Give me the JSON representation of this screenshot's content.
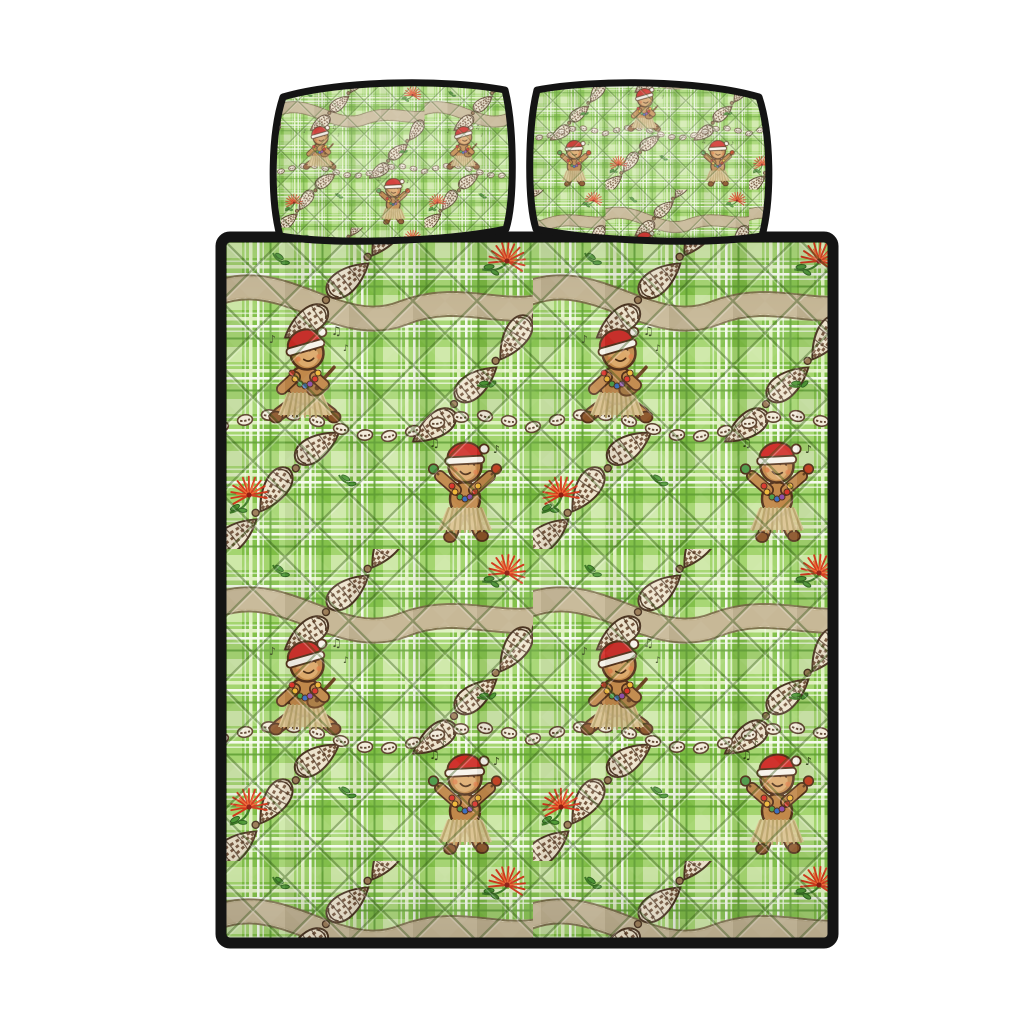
{
  "scene": {
    "label": "Quilt bedding set product photo: green plaid Hawaiian Christmas gingerbread pattern quilt with two matching pillow shams, black binding, white background",
    "items": [
      {
        "name": "pillow-sham-left",
        "type": "pillow"
      },
      {
        "name": "pillow-sham-right",
        "type": "pillow"
      },
      {
        "name": "quilt",
        "type": "quilt"
      }
    ]
  },
  "pattern": {
    "theme": "hawaiian-christmas-gingerbread",
    "fabric": "green-plaid-with-diamond-quilting",
    "motifs": [
      "gingerbread-hula-sitting-ukulele",
      "gingerbread-hula-dancing-maracas",
      "santa-hat",
      "candy-lights-lei",
      "grass-skirt",
      "cone-shell-garland",
      "puka-shell-strand",
      "white-flower-lei",
      "red-lehua-blossom",
      "green-leaf-sprig",
      "music-notes"
    ]
  },
  "colors": {
    "bg": "#ffffff",
    "binding": "#141414",
    "plaid-base": "#7ebe44",
    "plaid-light": "#a9d874",
    "plaid-pale": "#dff0c0",
    "plaid-white": "#f4faeb",
    "plaid-dark": "#5e9e33",
    "stitch": "#2f5516",
    "ginger": "#c1884a",
    "ginger-dark": "#53311a",
    "ginger-light": "#ddab6c",
    "cheek": "#df7a44",
    "hat-red": "#ce2a24",
    "hat-white": "#f7f3ea",
    "boot": "#8a5328",
    "skirt": "#dcc794",
    "skirt-line": "#b9a369",
    "uke": "#a97b42",
    "uke-dark": "#6b4423",
    "shell-cream": "#ede3cc",
    "shell-brown": "#6b4930",
    "shell-outline": "#4a3421",
    "bead": "#9a7b55",
    "cowrie-cream": "#f2ebda",
    "cowrie-brown": "#5f4530",
    "flei-outline": "#7a6848",
    "flei-cream": "#e9dfc6",
    "flei-light": "#f7f1e1",
    "flei-shadow": "#b3a078",
    "lehua": "#d2381c",
    "lehua-light": "#f06a35",
    "lehua-core": "#8f1d12",
    "leaf": "#4f9937",
    "leaf-dark": "#2f6420",
    "stem": "#3e7b27",
    "note": "#2e3e14",
    "lei-red": "#d8342b",
    "lei-gold": "#f0b93b",
    "lei-green": "#4fa14a",
    "lei-blue": "#3b6fc0",
    "lei-purple": "#8e4fa8",
    "maraca-green": "#4fa14a",
    "maraca-red": "#c8401f"
  }
}
